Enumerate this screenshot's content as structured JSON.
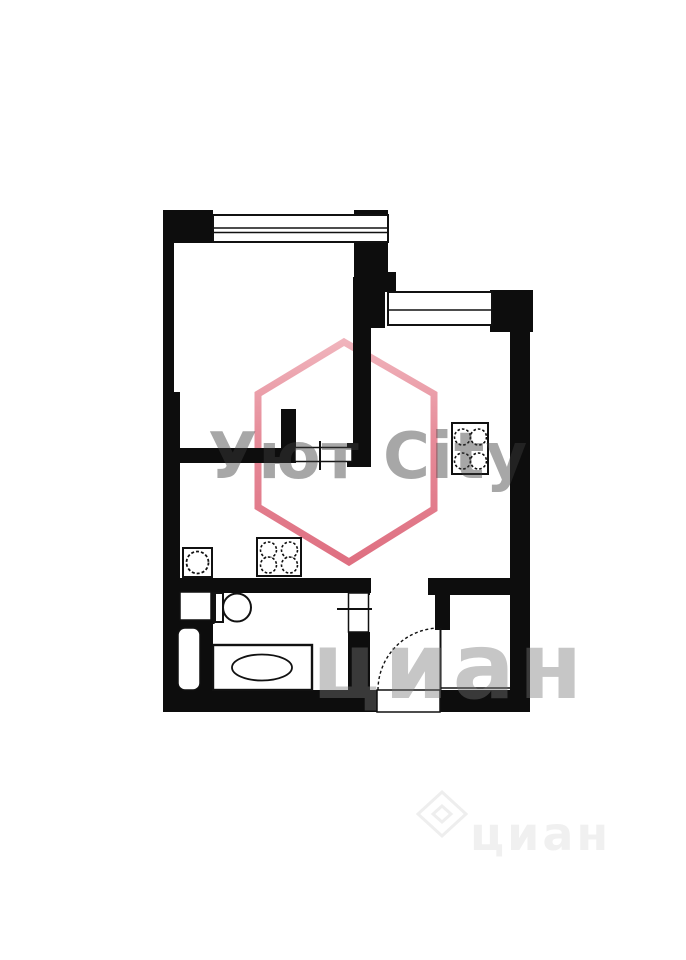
{
  "watermarks": {
    "brand": "Уют City",
    "brand_color": "#d9566b",
    "brand_text_color": "#8f8f8f",
    "portal_mid": "циан",
    "portal_bottom": "циан",
    "portal_color": "#c6c6c6"
  },
  "floor_plan": {
    "type": "apartment-floor-plan",
    "wall_color": "#0d0d0d",
    "fixtures": [
      "window-icon-living-room",
      "window-icon-kitchen-room",
      "stove-icon-right-room",
      "stove-icon-left-room",
      "sink-icon",
      "toilet-icon",
      "bathtub-icon",
      "entrance-door-arc-icon",
      "doorway-opening-icon-living",
      "doorway-opening-icon-bathroom"
    ]
  }
}
